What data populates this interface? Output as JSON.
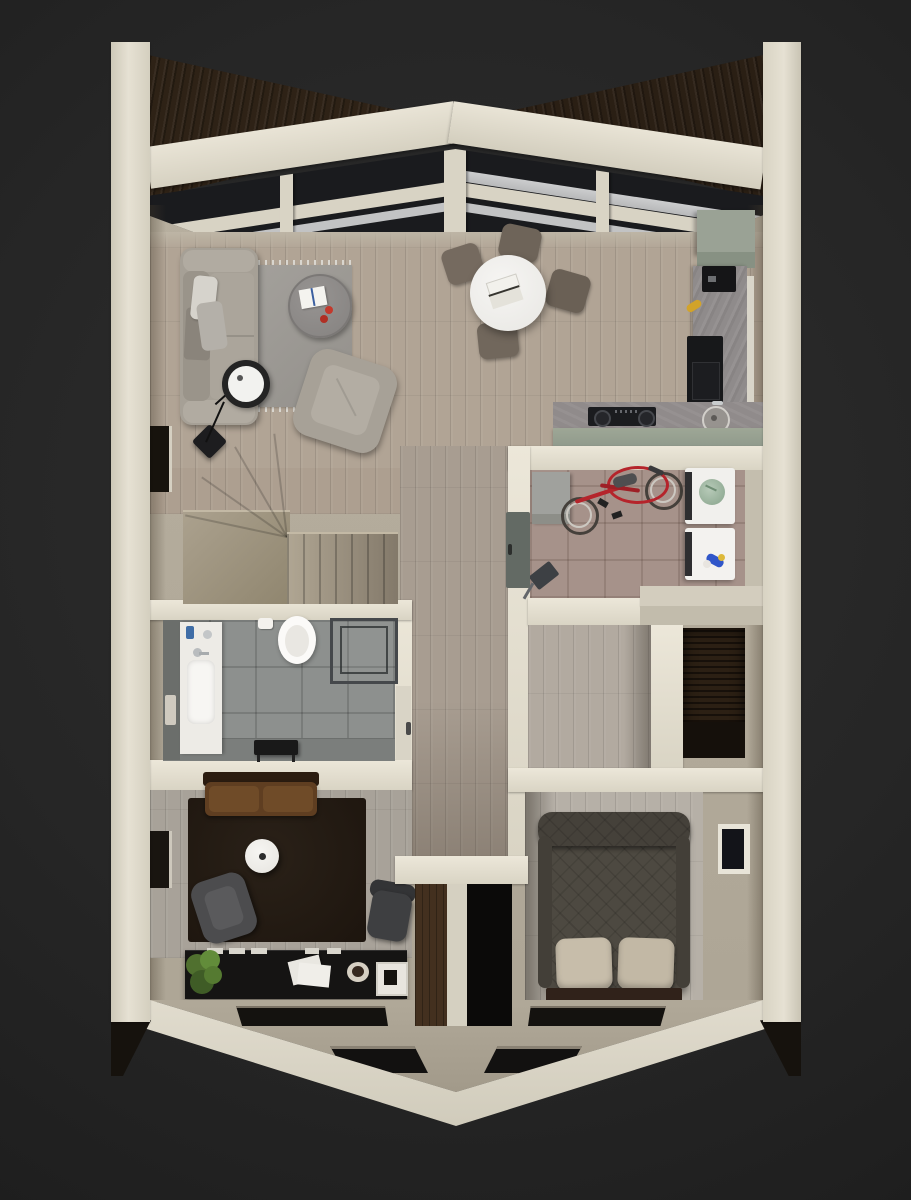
{
  "scene": {
    "title": "3D floor plan - top-down cutaway render",
    "style": "photorealistic apartment render with cream cut walls on dark backdrop",
    "background": "#1f1f1f",
    "wall_color": "#ddd8c9"
  },
  "rooms": {
    "roof": {
      "label": "Glass roof with gable beams and skylight glazing"
    },
    "living": {
      "label": "Living room: gray sofa, pillows, arc floor lamp, round coffee table with book and apples, fringed gray rug, gray armchair, wall window"
    },
    "dining": {
      "label": "Dining area: round white table, open laptop, four taupe chairs"
    },
    "kitchen": {
      "label": "Kitchen: sage tall cabinet, stone counters, coffee machine, banana, built-in oven, gas hob, round sink"
    },
    "utility": {
      "label": "Utility room: red bicycle on tiled floor, gray cabinet, stacked washer and dryer with laundry and detergent, dustpan, corner steps"
    },
    "stairs": {
      "label": "Staircase: winder steps turning into straight flight"
    },
    "bathroom": {
      "label": "Bathroom: white vanity with basin, toilet, paper roll, glass shower, black bench, gray tiles"
    },
    "corridor": {
      "label": "Corridor: wood plank floor, bathroom door, utility door"
    },
    "closet": {
      "label": "Walk-in closet: wood floor beside dark slatted niche"
    },
    "lounge": {
      "label": "TV lounge: brown leather loveseat, dark rug, white round side table, gray armchair, desk chair, black media console with plant, papers, bowl and frame, wall TV"
    },
    "bedroom": {
      "label": "Bedroom: double bed with dark quilted cover, two beige pillows, dark wood base, wall TV panel"
    },
    "hall": {
      "label": "Entry hall: beige floor, wood partition, dark doorway, recessed floor window slots in sloped wall"
    }
  },
  "palette": {
    "background": "#1f1f1f",
    "walls": "#ddd8c9",
    "roof_wood": "#2e2216",
    "wood_floor": "#b0a494",
    "bath_tile": "#8d908e",
    "utility_tile": "#a6928a",
    "accent_red_bike": "#b5242b",
    "sage_kitchen": "#9aa295",
    "dark_rug": "#241c14",
    "bed_cover": "#4d4941",
    "skylight_glass": "#1a1b1e"
  }
}
